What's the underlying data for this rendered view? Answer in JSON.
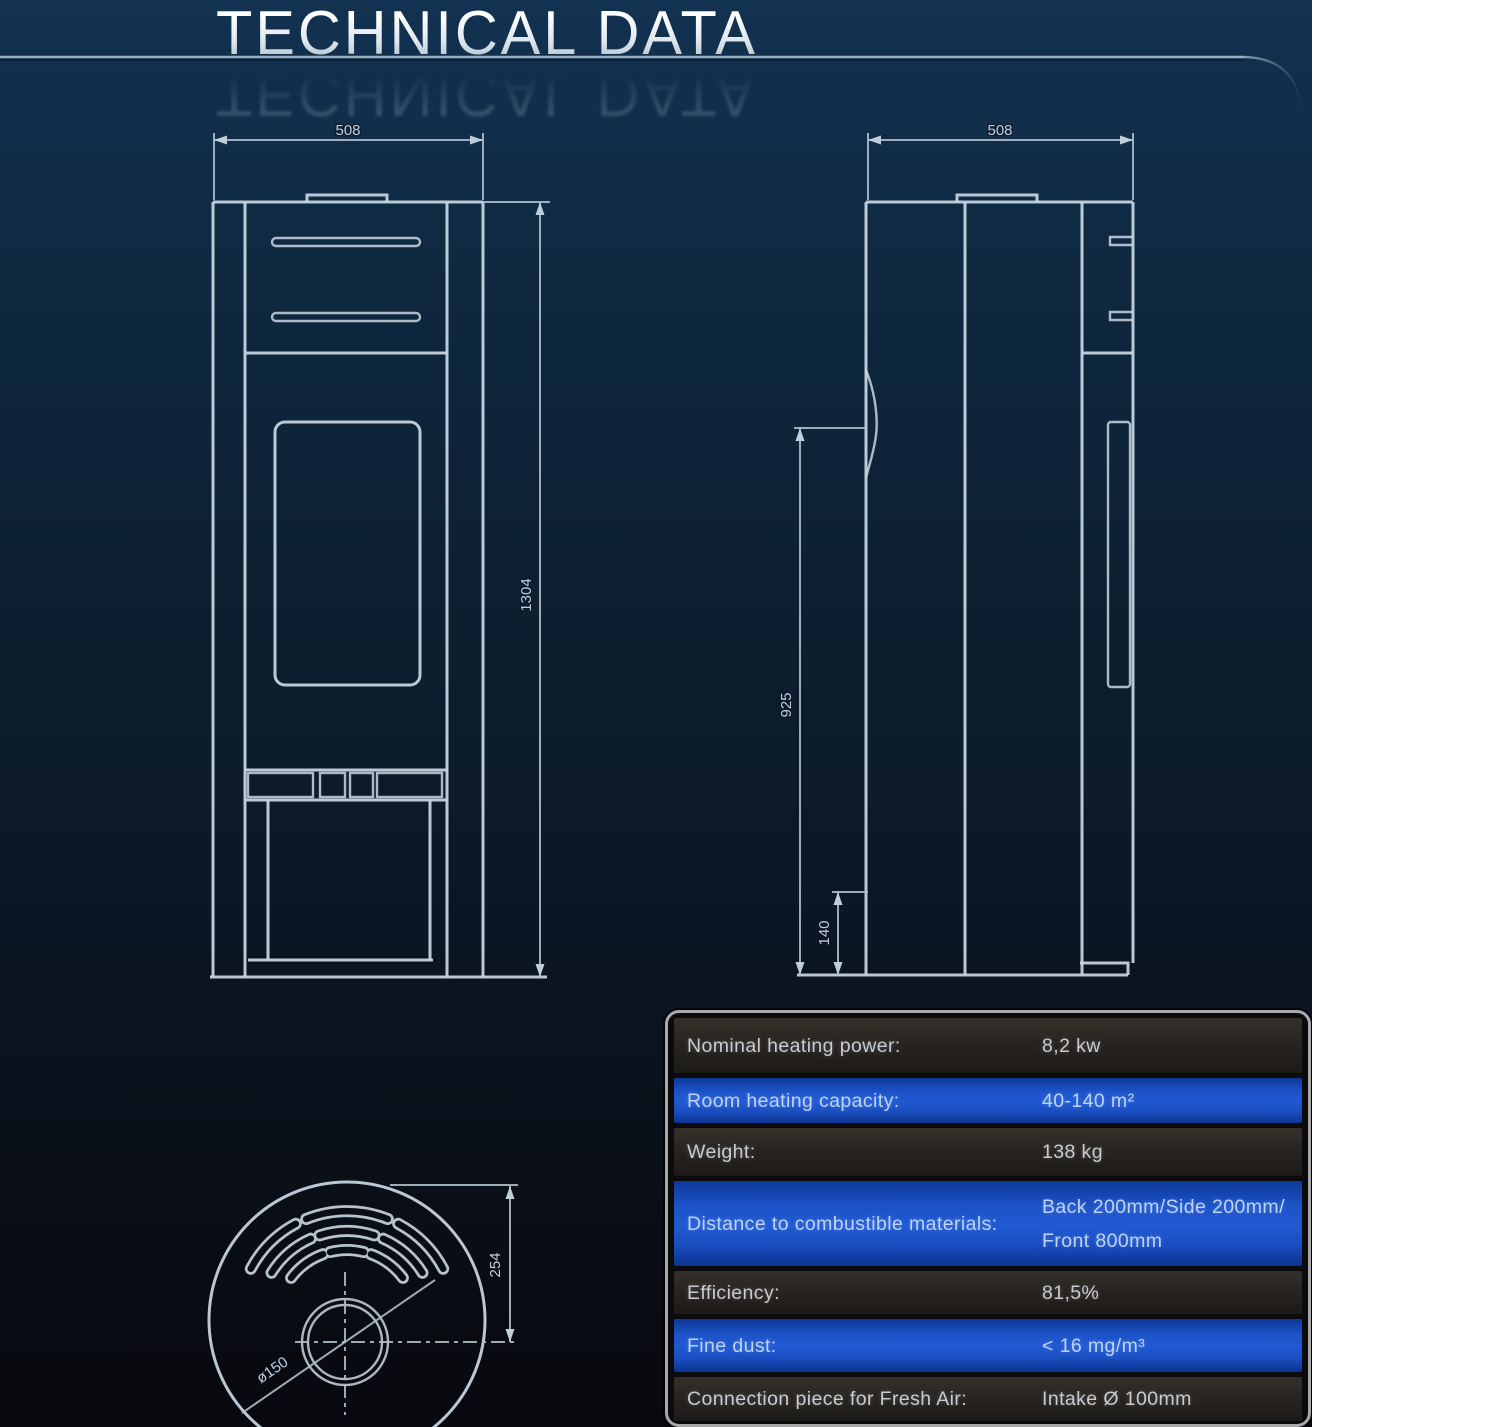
{
  "header": {
    "title": "TECHNICAL DATA"
  },
  "drawings": {
    "front_view": {
      "width_label": "508",
      "height_label": "1304"
    },
    "side_view": {
      "depth_label": "508",
      "upper_height_label": "925",
      "lower_height_label": "140"
    },
    "top_view": {
      "offset_label": "254",
      "flue_diameter_label": "ø150"
    }
  },
  "table": {
    "rows": [
      {
        "label": "Nominal heating power:",
        "value": "8,2 kw",
        "highlight": false
      },
      {
        "label": "Room heating capacity:",
        "value": "40-140 m²",
        "highlight": true
      },
      {
        "label": "Weight:",
        "value": "138 kg",
        "highlight": false
      },
      {
        "label": "Distance to combustible materials:",
        "value": "Back 200mm/Side 200mm/\nFront 800mm",
        "highlight": true
      },
      {
        "label": "Efficiency:",
        "value": "81,5%",
        "highlight": false
      },
      {
        "label": "Fine dust:",
        "value": "< 16 mg/m³",
        "highlight": true
      },
      {
        "label": "Connection piece for Fresh Air:",
        "value": "Intake Ø 100mm",
        "highlight": false
      },
      {
        "label": "",
        "value": "",
        "highlight": true
      }
    ]
  },
  "colors": {
    "accent_blue_row": "#1c53c8",
    "dark_row": "#282420",
    "background_top": "#123251",
    "background_bottom": "#08090e",
    "line": "#c9d6e2"
  }
}
